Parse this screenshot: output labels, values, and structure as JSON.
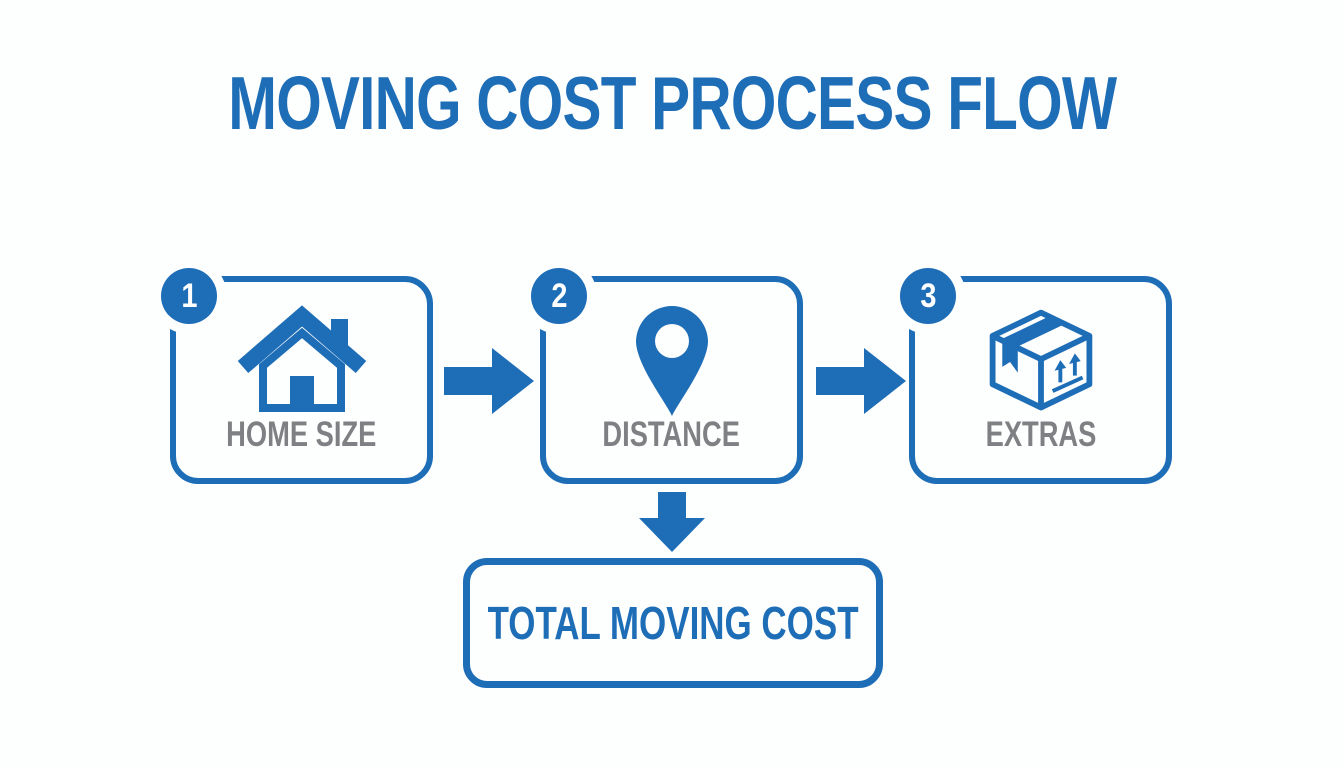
{
  "diagram": {
    "title": "MOVING COST PROCESS FLOW",
    "steps": [
      {
        "number": "1",
        "label": "HOME SIZE",
        "icon": "house-icon"
      },
      {
        "number": "2",
        "label": "DISTANCE",
        "icon": "location-pin-icon"
      },
      {
        "number": "3",
        "label": "EXTRAS",
        "icon": "moving-box-icon"
      }
    ],
    "connectors": [
      "right-arrow",
      "right-arrow",
      "down-arrow"
    ],
    "result": {
      "label": "TOTAL MOVING COST"
    },
    "colors": {
      "primary_blue": "#1e6db7",
      "label_gray": "#7e8083",
      "badge_text": "#ffffff",
      "background": "#fdfefe"
    }
  }
}
